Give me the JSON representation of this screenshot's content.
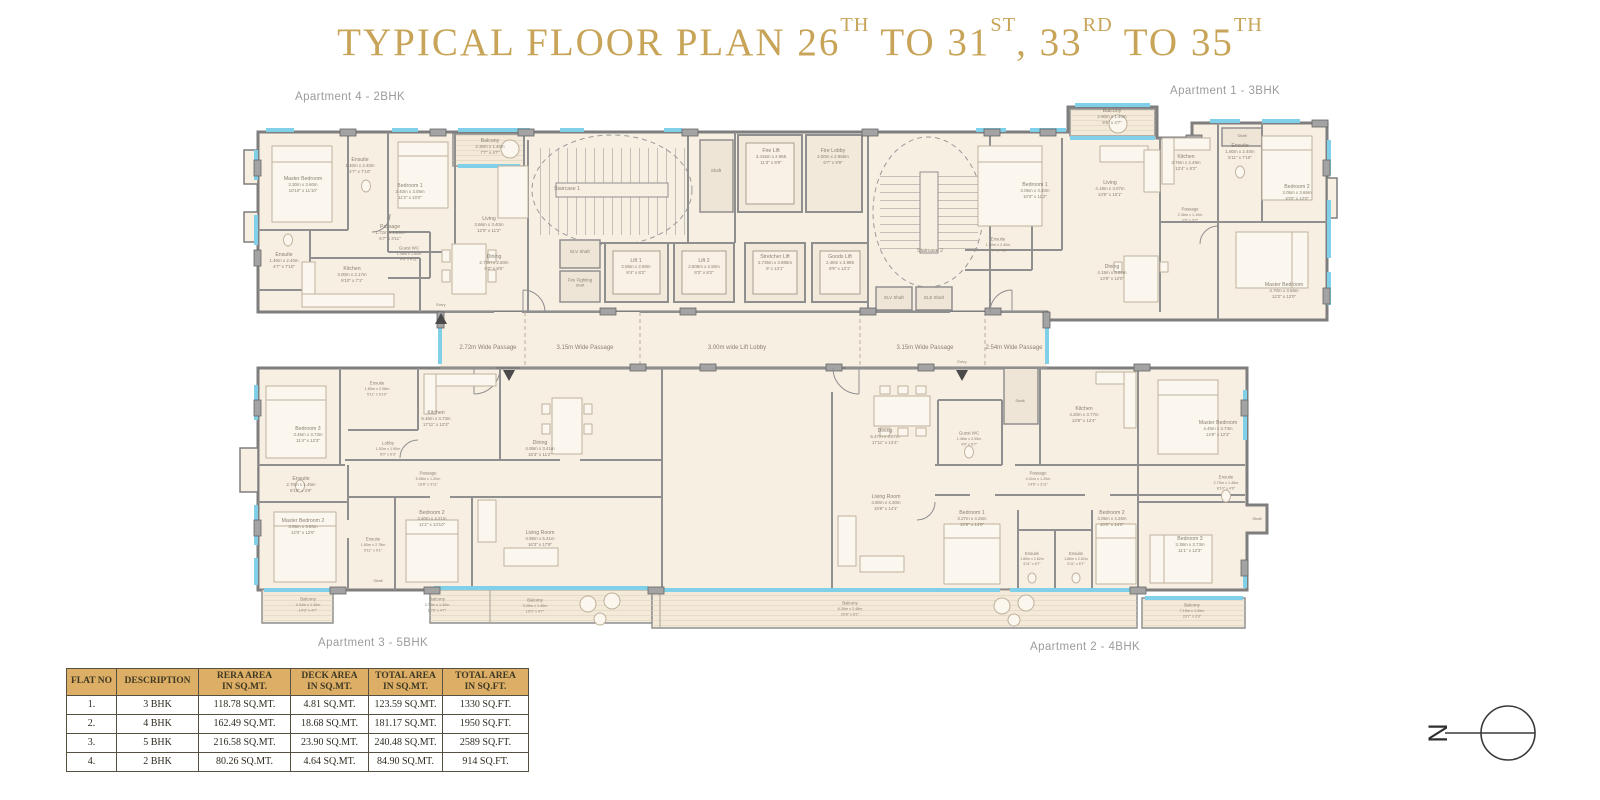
{
  "colors": {
    "title_gold": "#c7a458",
    "table_header_bg": "#dcae66",
    "wall_gray": "#8f8f8f",
    "floor_cream": "#f8efe3",
    "window_cyan": "#7fd0e8"
  },
  "title": {
    "segments": [
      {
        "text": "TYPICAL FLOOR PLAN  26"
      },
      {
        "text": "TH",
        "sup": true
      },
      {
        "text": " TO 31"
      },
      {
        "text": "ST",
        "sup": true
      },
      {
        "text": ", 33"
      },
      {
        "text": "RD",
        "sup": true
      },
      {
        "text": " TO 35"
      },
      {
        "text": "TH",
        "sup": true
      }
    ]
  },
  "plan": {
    "apartment_labels": [
      {
        "text": "Apartment 4 - 2BHK",
        "x": 295,
        "y": 100
      },
      {
        "text": "Apartment 1 - 3BHK",
        "x": 1170,
        "y": 94
      },
      {
        "text": "Apartment 3 - 5BHK",
        "x": 318,
        "y": 646
      },
      {
        "text": "Apartment 2 - 4BHK",
        "x": 1030,
        "y": 650
      }
    ],
    "room_labels": [
      {
        "x": 567,
        "y": 190,
        "lines": [
          "Staircase 1"
        ]
      },
      {
        "x": 930,
        "y": 252,
        "lines": [
          "Staircase 2"
        ]
      },
      {
        "x": 771,
        "y": 158,
        "lines": [
          "Fire Lift",
          "3.415m x 2.965",
          "11'3\" x 9'9\""
        ]
      },
      {
        "x": 833,
        "y": 158,
        "lines": [
          "Fire Lobby",
          "2.00m x 2.965m",
          "6'7\" x 9'9\""
        ]
      },
      {
        "x": 636,
        "y": 268,
        "lines": [
          "Lift 1",
          "2.55m x 2.50m",
          "8'4\" x 8'2\""
        ]
      },
      {
        "x": 704,
        "y": 268,
        "lines": [
          "Lift 2",
          "2.505m x 2.50m",
          "8'3\" x 8'2\""
        ]
      },
      {
        "x": 775,
        "y": 264,
        "lines": [
          "Stretcher Lift",
          "2.735m x 3.985m",
          "9' x 13'1\""
        ]
      },
      {
        "x": 840,
        "y": 264,
        "lines": [
          "Goods Lift",
          "2.48m x 3.985",
          "8'9\" x 13'1\""
        ]
      },
      {
        "x": 580,
        "y": 253,
        "lines": [
          "ELV Shaft"
        ],
        "size": 4.4
      },
      {
        "x": 580,
        "y": 284,
        "lines": [
          "Fire Fighting",
          "Shaft"
        ],
        "size": 4.4
      },
      {
        "x": 894,
        "y": 299,
        "lines": [
          "ELV Shaft"
        ],
        "size": 4.4
      },
      {
        "x": 934,
        "y": 299,
        "lines": [
          "ELE Shaft"
        ],
        "size": 4.4
      },
      {
        "x": 716,
        "y": 172,
        "lines": [
          "Shaft"
        ],
        "size": 4.4
      },
      {
        "x": 488,
        "y": 349,
        "lines": [
          "2.72m Wide Passage"
        ],
        "size": 6
      },
      {
        "x": 585,
        "y": 349,
        "lines": [
          "3.15m Wide Passage"
        ],
        "size": 6
      },
      {
        "x": 737,
        "y": 349,
        "lines": [
          "3.00m wide Lift Lobby"
        ],
        "size": 6
      },
      {
        "x": 925,
        "y": 349,
        "lines": [
          "3.15m Wide Passage"
        ],
        "size": 6
      },
      {
        "x": 1014,
        "y": 349,
        "lines": [
          "2.54m Wide Passage"
        ],
        "size": 6
      },
      {
        "x": 441,
        "y": 306,
        "lines": [
          "Entry"
        ],
        "size": 4
      },
      {
        "x": 962,
        "y": 363,
        "lines": [
          "Entry"
        ],
        "size": 4
      },
      {
        "x": 303,
        "y": 186,
        "lines": [
          "Master Bedroom",
          "3.30m x 3.60m",
          "10'10\" x 11'10\""
        ]
      },
      {
        "x": 360,
        "y": 167,
        "lines": [
          "Ensuite",
          "1.40m x 2.40m",
          "4'7\" x 7'10\""
        ]
      },
      {
        "x": 410,
        "y": 193,
        "lines": [
          "Bedroom 1",
          "3.40m x 3.05m",
          "11'2\" x 10'0\""
        ]
      },
      {
        "x": 490,
        "y": 148,
        "lines": [
          "Balcony",
          "2.30m x 1.40m",
          "7'7\" x 4'7\""
        ]
      },
      {
        "x": 489,
        "y": 226,
        "lines": [
          "Living",
          "3.66m x 3.40m",
          "12'0\" x 11'2\""
        ]
      },
      {
        "x": 494,
        "y": 264,
        "lines": [
          "Dining",
          "2.75m x 2.60m",
          "9'0\" x 8'6\""
        ]
      },
      {
        "x": 390,
        "y": 234,
        "lines": [
          "Passage",
          "1.72m x 1.20m",
          "5'7\" x 3'11\""
        ]
      },
      {
        "x": 352,
        "y": 276,
        "lines": [
          "Kitchen",
          "3.00m x 2.17m",
          "9'10\" x 7'1\""
        ]
      },
      {
        "x": 284,
        "y": 262,
        "lines": [
          "Ensuite",
          "1.40m x 2.40m",
          "4'7\" x 7'10\""
        ]
      },
      {
        "x": 409,
        "y": 255,
        "lines": [
          "Guest WC",
          "1.46m x 1.50m",
          "4'9\" x 4'11\""
        ],
        "size": 4.4
      },
      {
        "x": 1035,
        "y": 192,
        "lines": [
          "Bedroom 1",
          "3.05m x 3.40m",
          "10'0\" x 11'2\""
        ]
      },
      {
        "x": 1110,
        "y": 190,
        "lines": [
          "Living",
          "4.19m x 3.07m",
          "13'9\" x 10'1\""
        ]
      },
      {
        "x": 1112,
        "y": 274,
        "lines": [
          "Dining",
          "4.19m x 3.66m",
          "13'9\" x 12'0\""
        ]
      },
      {
        "x": 1112,
        "y": 118,
        "lines": [
          "Balcony",
          "2.90m x 1.40m",
          "9'6\" x 4'7\""
        ]
      },
      {
        "x": 1186,
        "y": 164,
        "lines": [
          "Kitchen",
          "3.76m x 2.49m",
          "12'4\" x 8'2\""
        ]
      },
      {
        "x": 998,
        "y": 246,
        "lines": [
          "Ensuite",
          "1.40m x 2.40m",
          "4'7\" x 7'10\""
        ],
        "size": 4.4
      },
      {
        "x": 1240,
        "y": 153,
        "lines": [
          "Ensuite",
          "1.80m x 2.40m",
          "5'11\" x 7'10\""
        ]
      },
      {
        "x": 1297,
        "y": 194,
        "lines": [
          "Bedroom 2",
          "3.05m x 3.66m",
          "10'0\" x 12'0\""
        ]
      },
      {
        "x": 1190,
        "y": 216,
        "lines": [
          "Passage",
          "2.36m x 1.10m",
          "7'9\" x 3'7\""
        ],
        "size": 4.4
      },
      {
        "x": 1284,
        "y": 292,
        "lines": [
          "Master Bedroom",
          "3.70m x 3.66m",
          "12'2\" x 12'0\""
        ]
      },
      {
        "x": 1242,
        "y": 137,
        "lines": [
          "Shaft"
        ],
        "size": 4
      },
      {
        "x": 308,
        "y": 436,
        "lines": [
          "Bedroom 3",
          "3.45m x 3.73m",
          "11'4\" x 12'3\""
        ]
      },
      {
        "x": 301,
        "y": 486,
        "lines": [
          "Ensuite",
          "2.70m x 1.45m",
          "8'10\" x 4'9\""
        ]
      },
      {
        "x": 303,
        "y": 528,
        "lines": [
          "Master Bedroom 2",
          "3.65m x 3.80m",
          "12'0\" x 12'6\""
        ]
      },
      {
        "x": 377,
        "y": 390,
        "lines": [
          "Ensuite",
          "1.80m x 2.08m",
          "5'11\" x 6'10\""
        ],
        "size": 4.4
      },
      {
        "x": 436,
        "y": 420,
        "lines": [
          "Kitchen",
          "5.45m x 3.73m",
          "17'11\" x 12'3\""
        ]
      },
      {
        "x": 388,
        "y": 450,
        "lines": [
          "Lobby",
          "1.52m x 1.90m",
          "5'0\" x 6'3\""
        ],
        "size": 4.4
      },
      {
        "x": 428,
        "y": 480,
        "lines": [
          "Passage",
          "5.08m x 1.20m",
          "16'8\" x 3'11\""
        ],
        "size": 4.4
      },
      {
        "x": 432,
        "y": 520,
        "lines": [
          "Bedroom 2",
          "3.40m x 4.21m",
          "11'2\" x 13'10\""
        ]
      },
      {
        "x": 373,
        "y": 546,
        "lines": [
          "Ensuite",
          "1.80m x 2.78m",
          "5'11\" x 9'1\""
        ],
        "size": 4.4
      },
      {
        "x": 540,
        "y": 450,
        "lines": [
          "Dining",
          "4.95m x 3.41m",
          "16'3\" x 11'2\""
        ]
      },
      {
        "x": 540,
        "y": 540,
        "lines": [
          "Living Room",
          "4.95m x 5.41m",
          "16'3\" x 17'9\""
        ]
      },
      {
        "x": 378,
        "y": 582,
        "lines": [
          "Shaft"
        ],
        "size": 4
      },
      {
        "x": 885,
        "y": 438,
        "lines": [
          "Dining",
          "5.47m x 4.07m",
          "17'11\" x 13'4\""
        ]
      },
      {
        "x": 886,
        "y": 504,
        "lines": [
          "Living Room",
          "4.80m x 4.30m",
          "15'9\" x 14'1\""
        ]
      },
      {
        "x": 969,
        "y": 440,
        "lines": [
          "Guest WC",
          "1.46m x 2.00m",
          "4'9\" x 6'7\""
        ],
        "size": 4.4
      },
      {
        "x": 1020,
        "y": 402,
        "lines": [
          "Shaft"
        ],
        "size": 4
      },
      {
        "x": 1084,
        "y": 416,
        "lines": [
          "Kitchen",
          "4.20m x 3.77m",
          "13'9\" x 12'4\""
        ]
      },
      {
        "x": 1038,
        "y": 480,
        "lines": [
          "Passage",
          "4.41m x 1.20m",
          "14'6\" x 3'11\""
        ],
        "size": 4.4
      },
      {
        "x": 972,
        "y": 520,
        "lines": [
          "Bedroom 1",
          "3.27m x 4.26m",
          "10'9\" x 14'0\""
        ]
      },
      {
        "x": 1112,
        "y": 520,
        "lines": [
          "Bedroom 2",
          "3.05m x 4.26m",
          "10'0\" x 14'0\""
        ]
      },
      {
        "x": 1032,
        "y": 560,
        "lines": [
          "Ensuite",
          "1.80m x 2.62m",
          "5'11\" x 8'7\""
        ],
        "size": 4.2
      },
      {
        "x": 1076,
        "y": 560,
        "lines": [
          "Ensuite",
          "1.80m x 2.62m",
          "5'11\" x 8'7\""
        ],
        "size": 4.2
      },
      {
        "x": 1218,
        "y": 430,
        "lines": [
          "Master Bedroom",
          "4.45m x 3.73m",
          "14'8\" x 12'3\""
        ]
      },
      {
        "x": 1226,
        "y": 484,
        "lines": [
          "Ensuite",
          "2.70m x 1.45m",
          "8'10\" x 4'9\""
        ],
        "size": 4.4
      },
      {
        "x": 1190,
        "y": 546,
        "lines": [
          "Bedroom 3",
          "3.38m x 3.73m",
          "11'1\" x 12'3\""
        ]
      },
      {
        "x": 1257,
        "y": 520,
        "lines": [
          "Shaft"
        ],
        "size": 4
      },
      {
        "x": 308,
        "y": 606,
        "lines": [
          "Balcony",
          "4.34m x 1.40m",
          "14'3\" x 4'7\""
        ],
        "size": 4.4
      },
      {
        "x": 437,
        "y": 606,
        "lines": [
          "Balcony",
          "3.78m x 1.40m",
          "12'5\" x 4'7\""
        ],
        "size": 4.4
      },
      {
        "x": 535,
        "y": 607,
        "lines": [
          "Balcony",
          "3.05m x 1.40m",
          "10'0\" x 4'7\""
        ],
        "size": 4.4
      },
      {
        "x": 850,
        "y": 610,
        "lines": [
          "Balcony",
          "6.30m x 2.46m",
          "20'8\" x 8'1\""
        ],
        "size": 4.4
      },
      {
        "x": 1192,
        "y": 612,
        "lines": [
          "Balcony",
          "7.19m x 1.00m",
          "23'7\" x 3'3\""
        ],
        "size": 4.4
      }
    ]
  },
  "area_table": {
    "columns": [
      "FLAT NO",
      "DESCRIPTION",
      "RERA AREA\nIN SQ.MT.",
      "DECK AREA\nIN SQ.MT.",
      "TOTAL AREA\nIN SQ.MT.",
      "TOTAL AREA\nIN SQ.FT."
    ],
    "rows": [
      [
        "1.",
        "3 BHK",
        "118.78 SQ.MT.",
        "4.81 SQ.MT.",
        "123.59 SQ.MT.",
        "1330 SQ.FT."
      ],
      [
        "2.",
        "4 BHK",
        "162.49 SQ.MT.",
        "18.68 SQ.MT.",
        "181.17 SQ.MT.",
        "1950 SQ.FT."
      ],
      [
        "3.",
        "5 BHK",
        "216.58 SQ.MT.",
        "23.90 SQ.MT.",
        "240.48 SQ.MT.",
        "2589 SQ.FT."
      ],
      [
        "4.",
        "2 BHK",
        "80.26 SQ.MT.",
        "4.64 SQ.MT.",
        "84.90 SQ.MT.",
        "914 SQ.FT."
      ]
    ]
  },
  "compass": {
    "north_label": "N"
  }
}
